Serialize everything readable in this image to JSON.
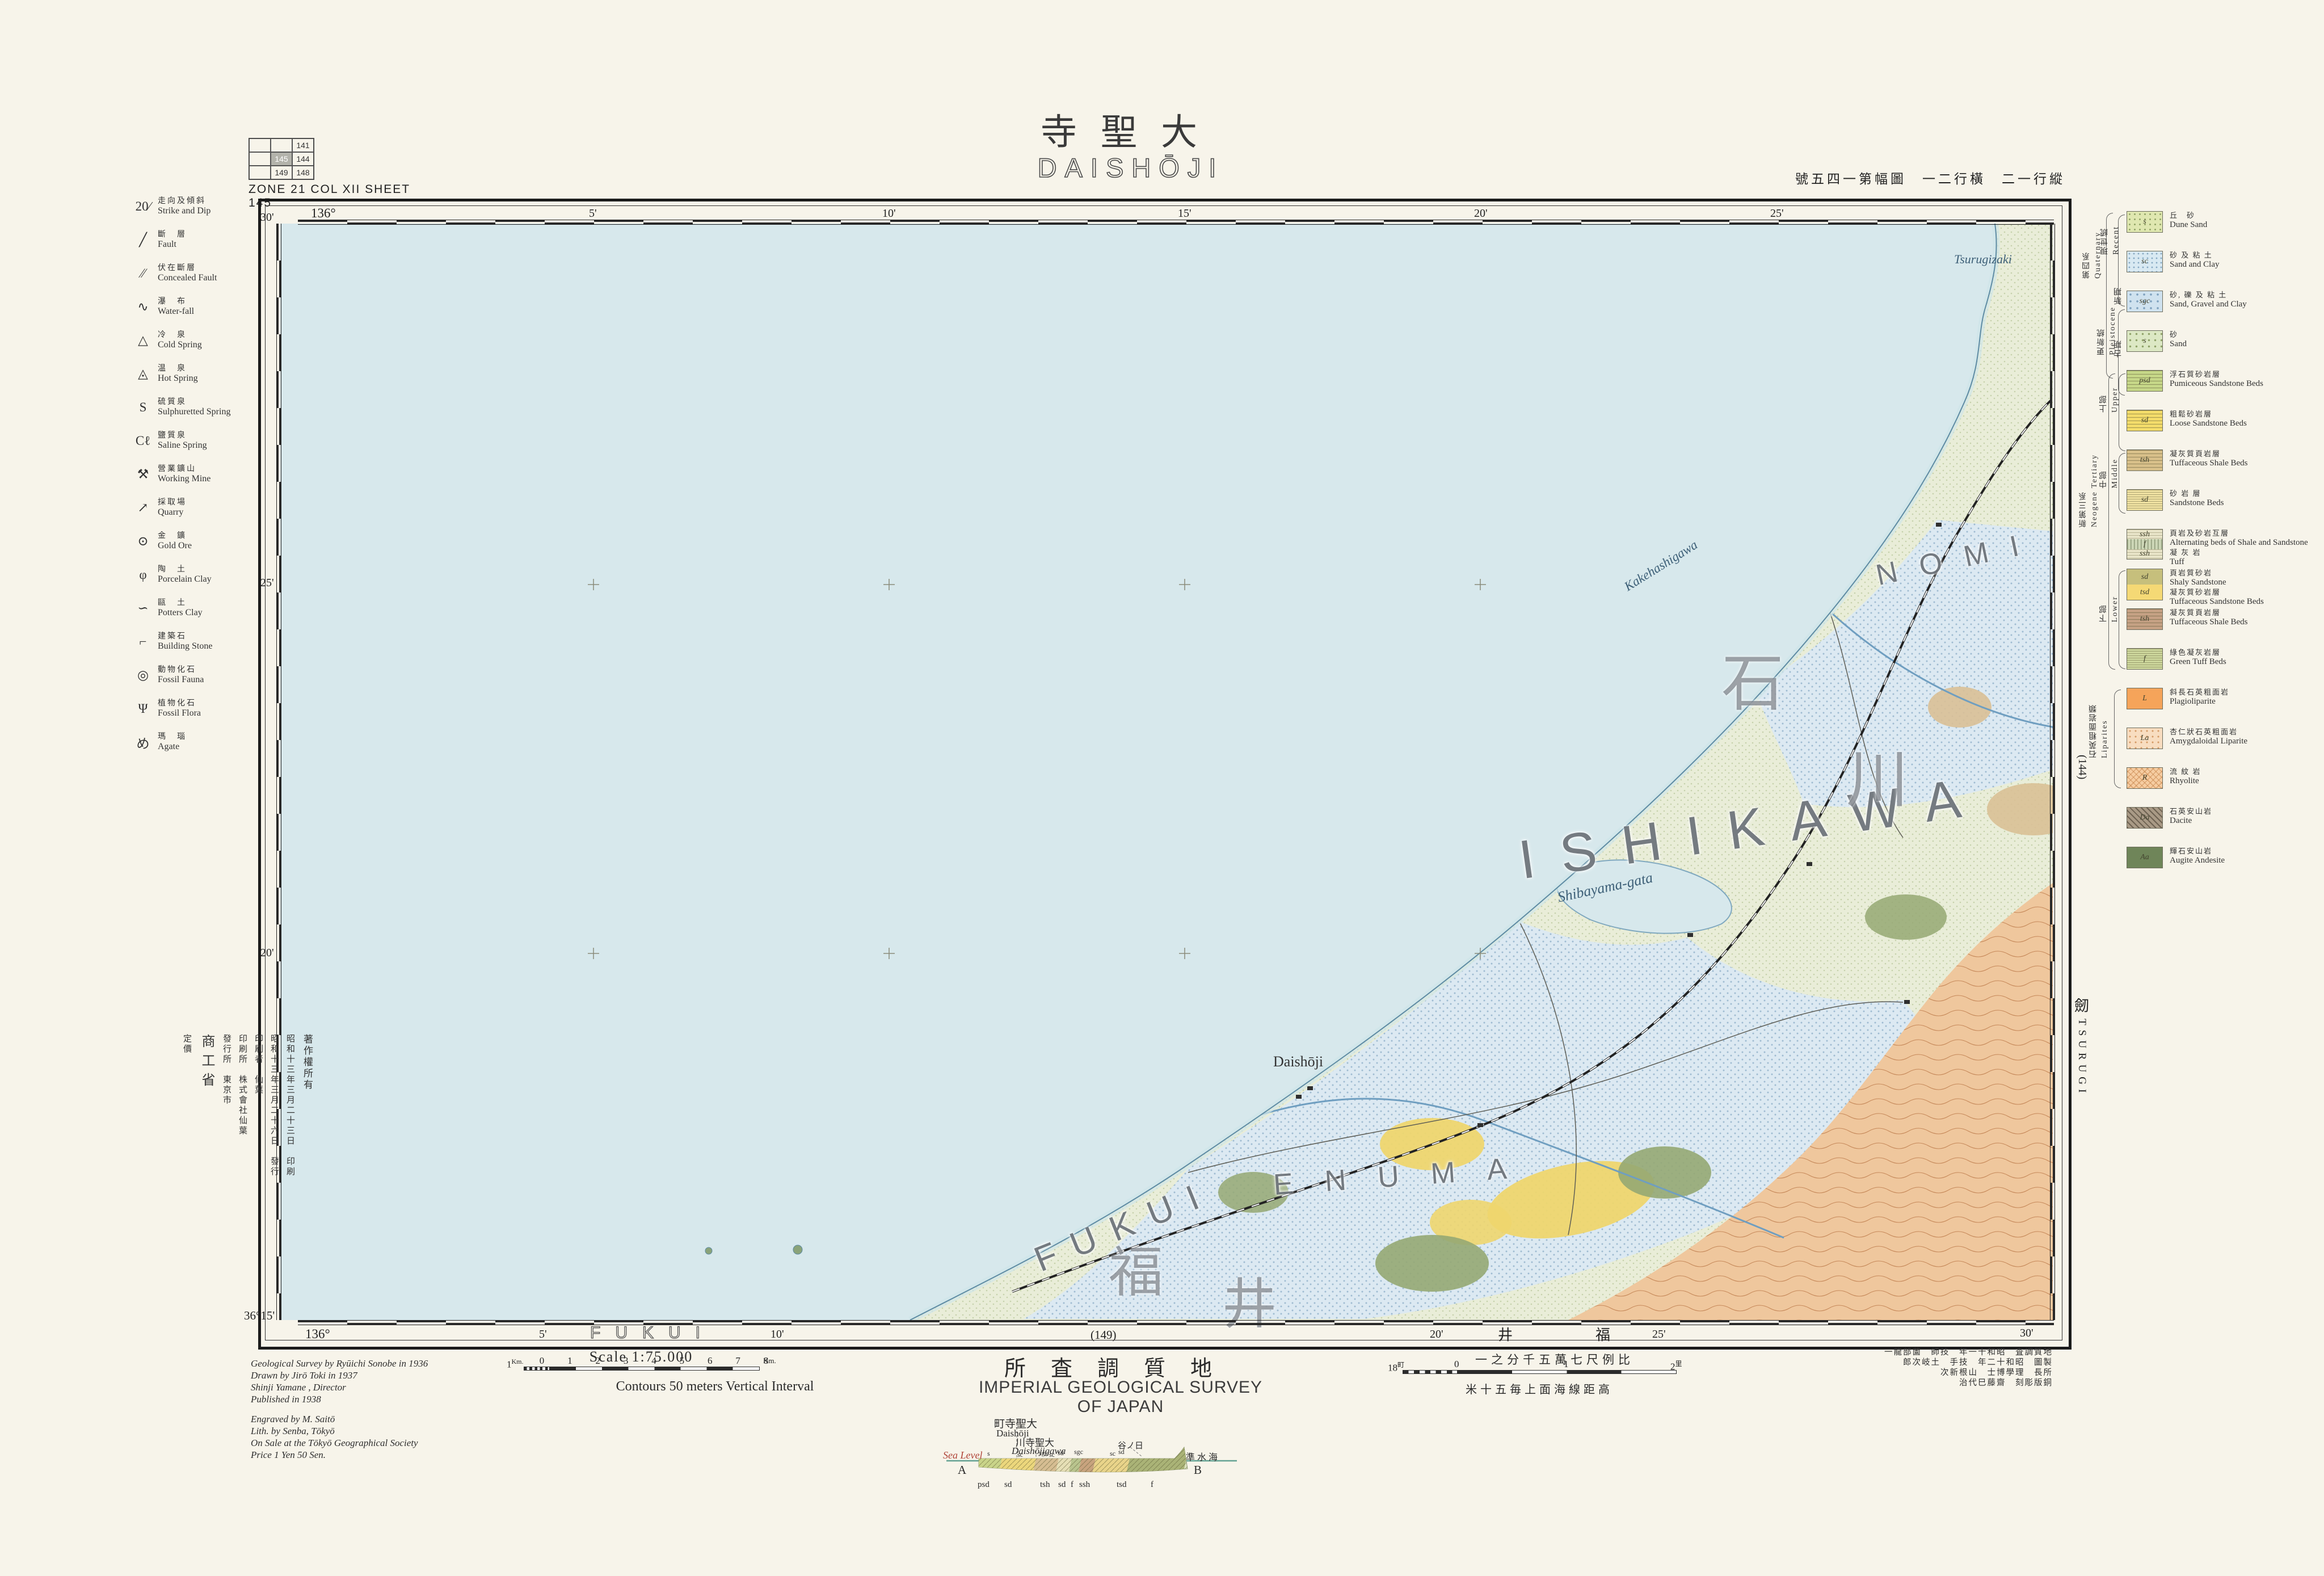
{
  "page": {
    "title_kanji": "寺聖大",
    "title_romaji": "DAISHŌJI",
    "sheet_caption": "ZONE 21  COL XII    SHEET 145",
    "top_right_note": "號五四一第幅圖　一二行橫　二一行縱"
  },
  "index_grid": {
    "cells": [
      "",
      "",
      "141",
      "",
      "145",
      "144",
      "",
      "149",
      "148"
    ]
  },
  "frame": {
    "top_ticks": [
      "136°",
      "5'",
      "10'",
      "15'",
      "20'",
      "25'"
    ],
    "left_ticks": [
      "30'",
      "25'",
      "20'",
      "36°15'"
    ],
    "bottom": {
      "lon0": "136°",
      "t5": "5'",
      "t10": "10'",
      "t20": "20'",
      "t25": "25'",
      "t30": "30'",
      "sheet_below": "(149)",
      "fukui_outline": "FUKUI",
      "fukui_kanji": "井　福"
    },
    "right": {
      "sheet_right": "(144)",
      "tsurugi_kanji": "劒",
      "tsurugi_romaji": "TSURUGI"
    }
  },
  "symbols": {
    "items": [
      {
        "glyph": "20∕",
        "jp": "走向及傾斜",
        "en": "Strike and Dip"
      },
      {
        "glyph": "╱",
        "jp": "斷　層",
        "en": "Fault"
      },
      {
        "glyph": "⁄⁄",
        "jp": "伏在斷層",
        "en": "Concealed Fault"
      },
      {
        "glyph": "∿",
        "jp": "瀑　布",
        "en": "Water-fall"
      },
      {
        "glyph": "△",
        "jp": "冷　泉",
        "en": "Cold Spring"
      },
      {
        "glyph": "◬",
        "jp": "温　泉",
        "en": "Hot Spring"
      },
      {
        "glyph": "S",
        "jp": "硫質泉",
        "en": "Sulphuretted Spring"
      },
      {
        "glyph": "Cℓ",
        "jp": "鹽質泉",
        "en": "Saline Spring"
      },
      {
        "glyph": "⚒",
        "jp": "營業鑛山",
        "en": "Working Mine"
      },
      {
        "glyph": "↗",
        "jp": "採取場",
        "en": "Quarry"
      },
      {
        "glyph": "⊙",
        "jp": "金　鑛",
        "en": "Gold Ore"
      },
      {
        "glyph": "φ",
        "jp": "陶　土",
        "en": "Porcelain Clay"
      },
      {
        "glyph": "∽",
        "jp": "甌　土",
        "en": "Potters Clay"
      },
      {
        "glyph": "⌐",
        "jp": "建築石",
        "en": "Building Stone"
      },
      {
        "glyph": "◎",
        "jp": "動物化石",
        "en": "Fossil Fauna"
      },
      {
        "glyph": "Ψ",
        "jp": "植物化石",
        "en": "Fossil Flora"
      },
      {
        "glyph": "め",
        "jp": "瑪　瑙",
        "en": "Agate"
      }
    ]
  },
  "geo": {
    "groups": {
      "quaternary_jp": "第四系",
      "quaternary_en": "Quaternary",
      "recent_jp": "現世統",
      "recent_en": "Recent",
      "pleistocene_jp": "更新統",
      "pleistocene_en": "Pleistocene",
      "younger_jp": "新期",
      "younger_en": "Younger",
      "older_jp": "古期",
      "older_en": "Older",
      "neogene_jp": "新第三系",
      "neogene_en": "Neogene Tertiary",
      "upper_jp": "上部",
      "upper_en": "Upper",
      "middle_jp": "中部",
      "middle_en": "Middle",
      "lower_jp": "下部",
      "lower_en": "Lower",
      "liparites_jp": "石英粗面岩類",
      "liparites_en": "Liparites"
    },
    "items": [
      {
        "code": "s",
        "jp": "丘　砂",
        "en": "Dune Sand",
        "color": "#dfe7b0",
        "pattern": "dots-g"
      },
      {
        "code": "sc",
        "jp": "砂 及 粘 土",
        "en": "Sand and Clay",
        "color": "#d8e9f2",
        "pattern": "dots-b"
      },
      {
        "code": "sgc",
        "jp": "砂, 礫 及 粘 土",
        "en": "Sand, Gravel and Clay",
        "color": "#cfe2ef",
        "pattern": "dots-b2"
      },
      {
        "code": "s",
        "jp": "砂",
        "en": "Sand",
        "color": "#dce8c4",
        "pattern": "dots-g2"
      },
      {
        "code": "psd",
        "jp": "浮石質砂岩層",
        "en": "Pumiceous Sandstone Beds",
        "color": "#c6d788",
        "pattern": "hl"
      },
      {
        "code": "sd",
        "jp": "粗鬆砂岩層",
        "en": "Loose Sandstone Beds",
        "color": "#f3dc6a",
        "pattern": "hl"
      },
      {
        "code": "tsh",
        "jp": "凝灰質頁岩層",
        "en": "Tuffaceous Shale Beds",
        "color": "#d8c08a",
        "pattern": "hl"
      },
      {
        "code": "sd",
        "jp": "砂 岩 層",
        "en": "Sandstone Beds",
        "color": "#f0e2a2",
        "pattern": "hl-d"
      },
      {
        "code": "ssh",
        "code2": "f",
        "code3": "ssh",
        "jp": "頁岩及砂岩互層",
        "en": "Alternating beds of Shale and Sandstone",
        "jp2": "凝 灰 岩",
        "en2": "Tuff",
        "color": "#e7e3c6",
        "pattern": "triple"
      },
      {
        "code": "sd",
        "code2": "tsd",
        "jp": "頁岩質砂岩",
        "en": "Shaly Sandstone",
        "jp2": "凝灰質砂岩層",
        "en2": "Tuffaceous Sandstone Beds",
        "color": "#f5d975",
        "pattern": "two"
      },
      {
        "code": "tsh",
        "jp": "凝灰質頁岩層",
        "en": "Tuffaceous Shale Beds",
        "color": "#c5a184",
        "pattern": "hl"
      },
      {
        "code": "f",
        "jp": "綠色凝灰岩層",
        "en": "Green Tuff Beds",
        "color": "#cdd79c",
        "pattern": "hl-d"
      },
      {
        "code": "L",
        "jp": "斜長石英粗面岩",
        "en": "Plagioliparite",
        "color": "#f5a45a",
        "pattern": "solid"
      },
      {
        "code": "La",
        "jp": "杏仁狀石英粗面岩",
        "en": "Amygdaloidal Liparite",
        "color": "#f8ddc0",
        "pattern": "dots-o"
      },
      {
        "code": "R",
        "jp": "流 紋 岩",
        "en": "Rhyolite",
        "color": "#f6cda2",
        "pattern": "cross"
      },
      {
        "code": "Da",
        "jp": "石英安山岩",
        "en": "Dacite",
        "color": "#a99a86",
        "pattern": "diag"
      },
      {
        "code": "Aa",
        "jp": "輝石安山岩",
        "en": "Augite Andesite",
        "color": "#6f8559",
        "pattern": "solid"
      }
    ]
  },
  "map": {
    "sea_color": "#d7e8ec",
    "land_color": "#e9edd8",
    "mountain_color": "#efc79d",
    "labels": {
      "ishikawa": "ISHIKAWA",
      "fukui": "FUKUI",
      "enuma": "ENUMA",
      "nomi": "NOMI",
      "ishi_kanji": "石",
      "kawa_kanji": "川",
      "fuku_kanji": "福",
      "i_kanji": "井",
      "shibayama": "Shibayama-gata",
      "kakehashi": "Kakehashigawa",
      "daishoji_town": "Daishōji",
      "tsurugizaki": "Tsurugizaki"
    }
  },
  "footer": {
    "scale_label": "Scale  1:75.000",
    "contours_label": "Contours 50 meters Vertical Interval",
    "survey_jp": "所査調質地",
    "survey_en": "IMPERIAL GEOLOGICAL SURVEY OF JAPAN",
    "scale_jp": "一之分千五萬七尺例比",
    "contour_jp": "米十五毎上面海線距高",
    "km_scale": {
      "pre": "1",
      "pre_unit": "Km.",
      "ticks": [
        "0",
        "1",
        "2",
        "3",
        "4",
        "5",
        "6",
        "7",
        "8"
      ],
      "post_unit": "Km."
    },
    "ri_scale": {
      "pre": "18",
      "pre_unit": "町",
      "t0": "0",
      "t1": "1",
      "t2": "2",
      "post_unit": "里"
    },
    "credits_left": [
      "Geological Survey by Ryūichi Sonobe in 1936",
      "Drawn by Jirō Toki in 1937",
      "Shinji Yamane , Director",
      "Published in 1938",
      "Engraved by M. Saitō",
      "Lith. by Senba, Tōkyō",
      "On Sale at the Tōkyō Geographical Society",
      "Price 1 Yen 50 Sen."
    ],
    "credits_right": [
      "一龍部薗　師技　年一十和昭　査調質地",
      "郎次岐土　手技　年二十和昭　圖製",
      "次新根山　士博學理　長所",
      "治代巳藤齋　刻彫版銅"
    ]
  },
  "colophon": {
    "lines": [
      "著作權所有",
      "昭和十三年三月二十三日　印刷",
      "昭和十三年三月二十六日　發行",
      "印刷者　仙葉",
      "印刷所　株式會社仙葉",
      "發行所　東京市",
      "商工省",
      "定價"
    ]
  },
  "section": {
    "sea_level_en": "Sea Level",
    "sea_level_jp": "準 水 海",
    "end_a": "A",
    "end_b": "B",
    "above": [
      {
        "jp": "町寺聖大",
        "en": "Daishōji"
      },
      {
        "jp": "川寺聖大",
        "en": "Daishōjigawa"
      },
      {
        "jp": "谷ノ日",
        "en": ""
      }
    ],
    "units_top": [
      "s",
      "sc",
      "sgc",
      "sc",
      "sd",
      "sgc",
      "sc",
      "sd"
    ],
    "units_bottom": [
      "psd",
      "sd",
      "tsh",
      "sd",
      "f",
      "ssh",
      "tsd",
      "f"
    ]
  }
}
